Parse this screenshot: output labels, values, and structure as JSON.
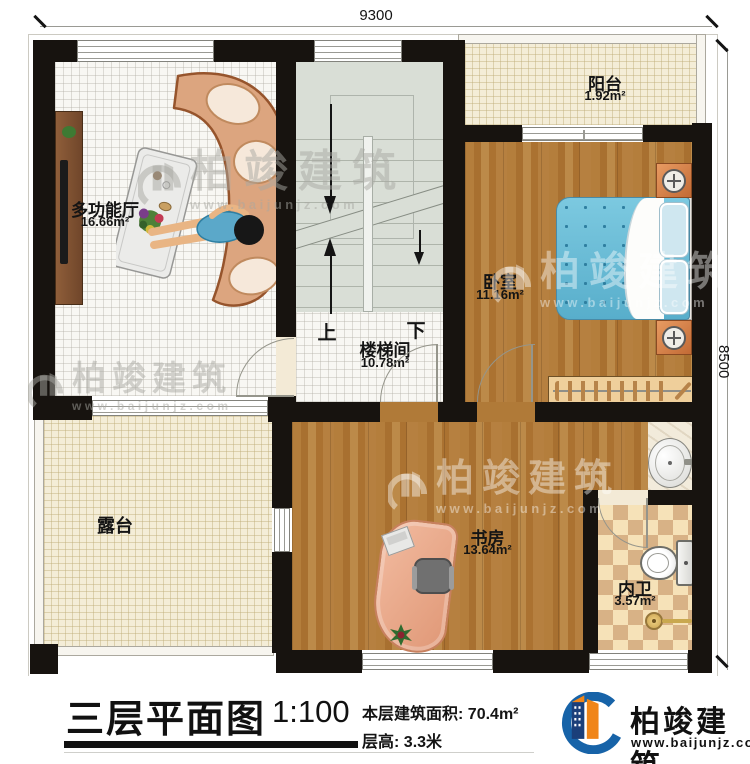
{
  "dimensions": {
    "width_mm": "9300",
    "height_mm": "8500"
  },
  "rooms": {
    "multi_hall": {
      "name": "多功能厅",
      "area": "16.66m²"
    },
    "stairwell": {
      "name": "楼梯间",
      "area": "10.78m²",
      "up_label": "上",
      "down_label": "下"
    },
    "balcony": {
      "name": "阳台",
      "area": "1.92m²"
    },
    "bedroom": {
      "name": "卧室",
      "area": "11.16m²"
    },
    "terrace": {
      "name": "露台"
    },
    "study": {
      "name": "书房",
      "area": "13.64m²"
    },
    "bathroom": {
      "name": "内卫",
      "area": "3.57m²"
    }
  },
  "title_block": {
    "title": "三层平面图",
    "scale": "1:100",
    "floor_area_label": "本层建筑面积:",
    "floor_area_value": "70.4m²",
    "floor_height_label": "层高:",
    "floor_height_value": "3.3米",
    "brand": "柏竣建筑",
    "website": "www.baijunjz.com"
  },
  "watermark": {
    "brand": "柏竣建筑",
    "website": "www.baijunjz.com"
  },
  "colors": {
    "brand_blue": "#1763A8",
    "brand_orange": "#F08519",
    "wall": "#17130F",
    "wood_floor": "#B07A38",
    "bed_blue": "#6FC0DB",
    "checker_tan": "#D8B286"
  }
}
